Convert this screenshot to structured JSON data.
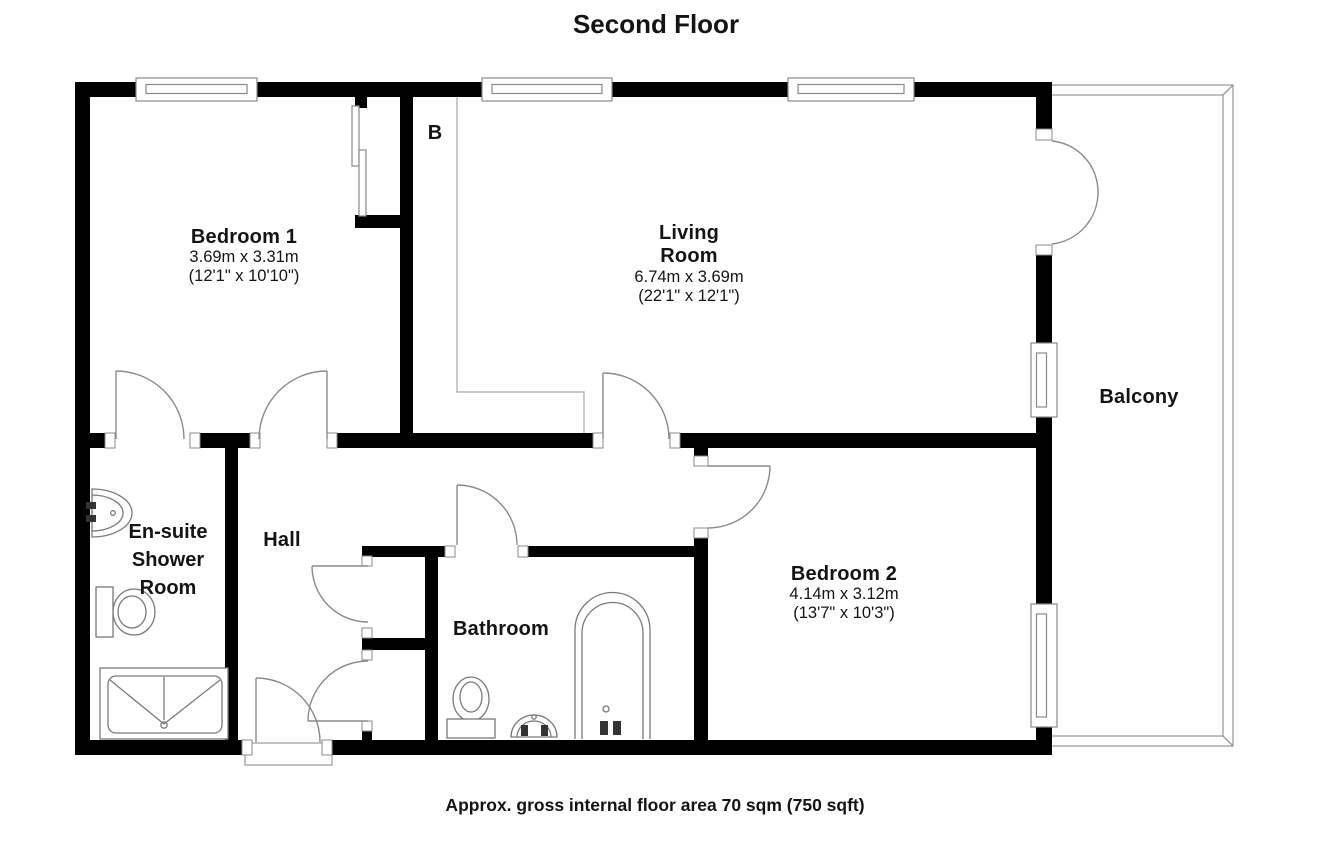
{
  "title": "Second Floor",
  "footer": "Approx. gross internal floor area 70 sqm (750 sqft)",
  "rooms": {
    "bedroom1": {
      "name": "Bedroom 1",
      "metric": "3.69m x 3.31m",
      "imperial": "(12'1\" x 10'10\")"
    },
    "living_room": {
      "line1": "Living",
      "line2": "Room",
      "metric": "6.74m x 3.69m",
      "imperial": "(22'1\" x 12'1\")"
    },
    "ensuite": {
      "line1": "En-suite",
      "line2": "Shower",
      "line3": "Room"
    },
    "hall": {
      "name": "Hall"
    },
    "bathroom": {
      "name": "Bathroom"
    },
    "bedroom2": {
      "name": "Bedroom 2",
      "metric": "4.14m x 3.12m",
      "imperial": "(13'7\" x 10'3\")"
    },
    "balcony": {
      "name": "Balcony"
    },
    "boiler_cupboard": {
      "label": "B"
    }
  },
  "colors": {
    "wall": "#000000",
    "fixture_line": "#7a7a7a",
    "outline": "#999999",
    "text": "#141414"
  }
}
